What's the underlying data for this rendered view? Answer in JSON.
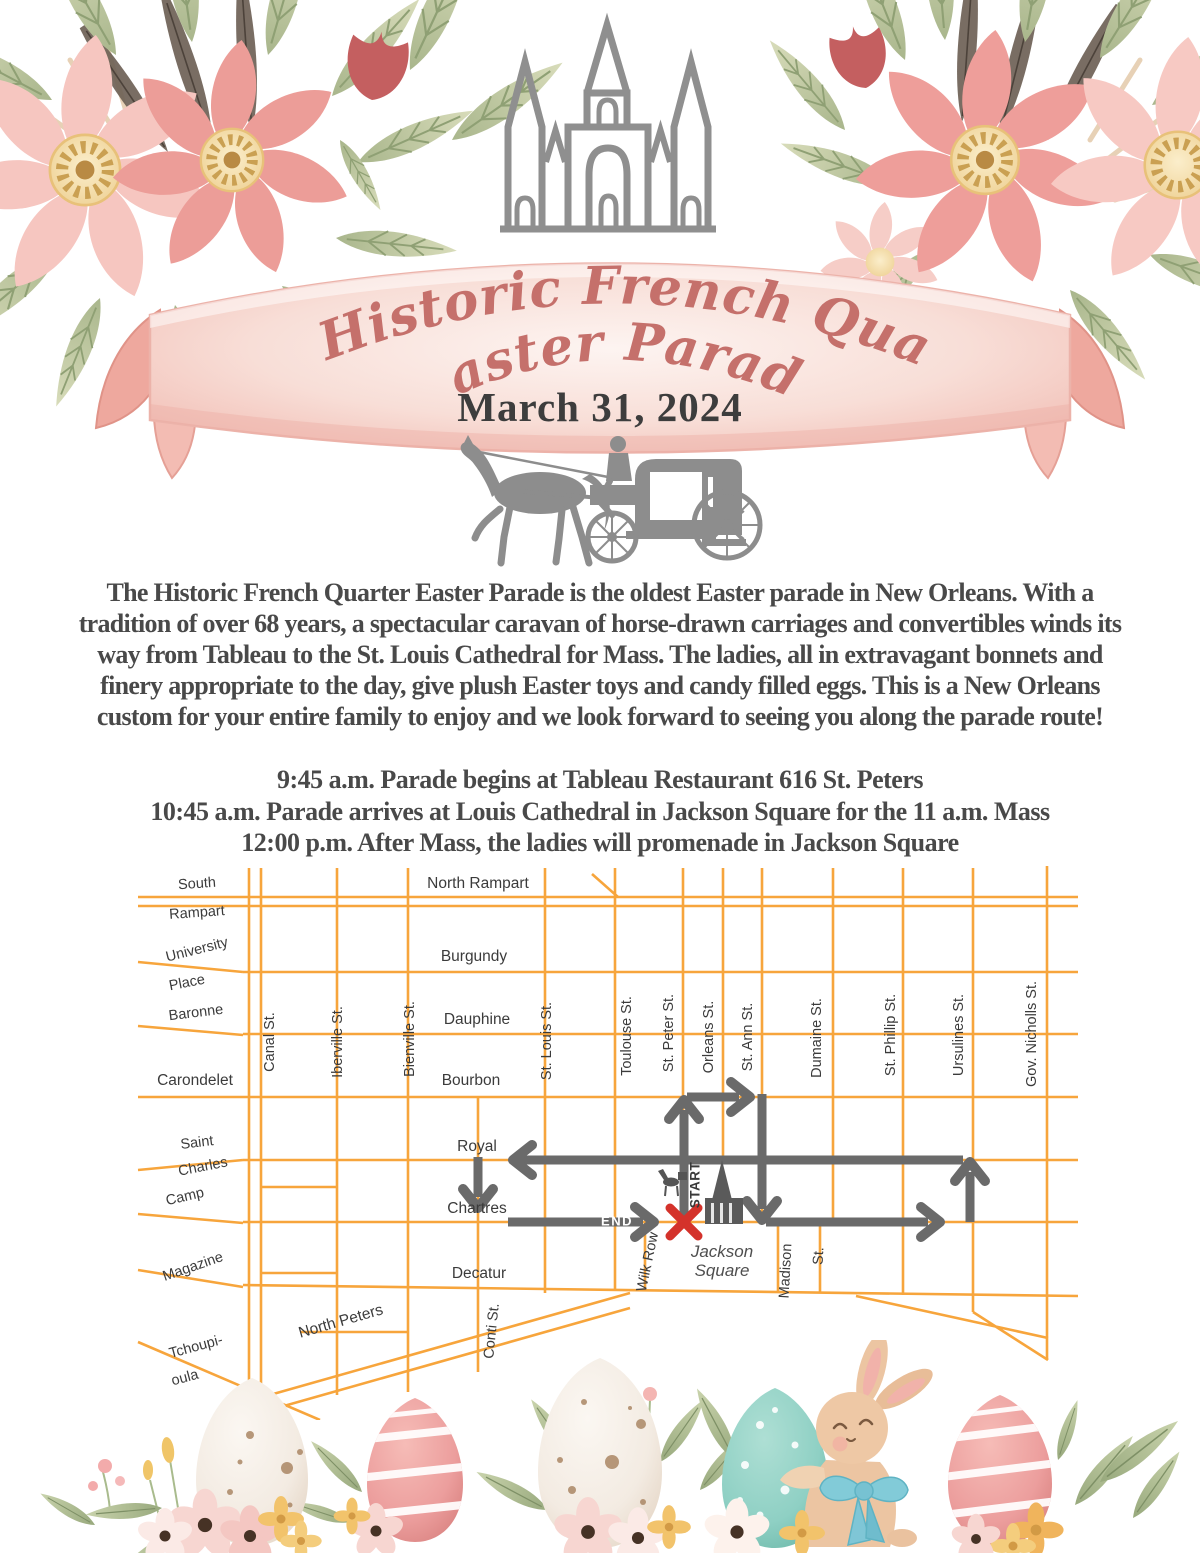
{
  "header": {
    "title_line1": "The Historic French Quarter",
    "title_line2": "Easter Parade",
    "date": "March 31, 2024"
  },
  "intro": {
    "lines": [
      "The Historic French Quarter Easter Parade is the oldest Easter parade in New Orleans. With a",
      "tradition of over 68 years, a spectacular caravan of horse-drawn carriages and convertibles winds its",
      "way from Tableau to the St. Louis Cathedral for Mass. The ladies, all in extravagant bonnets and",
      "finery appropriate to the day, give plush Easter toys and candy filled eggs. This is a New Orleans",
      "custom for your entire family to enjoy and we look forward to seeing you along the parade route!"
    ]
  },
  "schedule": {
    "lines": [
      "9:45 a.m. Parade begins at Tableau Restaurant 616 St. Peters",
      "10:45 a.m. Parade arrives at Louis Cathedral in Jackson Square for the 11 a.m. Mass",
      "12:00 p.m. After Mass, the ladies will promenade in Jackson Square"
    ]
  },
  "map": {
    "colors": {
      "street": "#F7A53C",
      "route": "#6A6A6A",
      "marker_x": "#D4322B",
      "label_text": "#3B3B3B",
      "title_rose": "#C5706B",
      "ribbon_pink": "#F5C9C1"
    },
    "labels": {
      "north_rampart": "North Rampart",
      "burgundy": "Burgundy",
      "dauphine": "Dauphine",
      "bourbon": "Bourbon",
      "royal": "Royal",
      "chartres": "Chartres",
      "decatur": "Decatur",
      "north_peters": "North Peters",
      "south": "South",
      "rampart": "Rampart",
      "university": "University",
      "place": "Place",
      "baronne": "Baronne",
      "carondelet": "Carondelet",
      "saint": "Saint",
      "charles": "Charles",
      "camp": "Camp",
      "magazine": "Magazine",
      "tchoupi": "Tchoupi-",
      "toulas": "oula",
      "canal": "Canal St.",
      "iberville": "Iberville St.",
      "bienville": "Bienville St.",
      "st_louis": "St. Louis St.",
      "toulouse": "Toulouse St.",
      "st_peter": "St. Peter St.",
      "orleans": "Orleans St.",
      "st_ann": "St. Ann St.",
      "dumaine": "Dumaine St.",
      "st_phillip": "St. Phillip St.",
      "ursulines": "Ursulines St.",
      "gov_nicholls": "Gov. Nicholls St.",
      "conti": "Conti St.",
      "wilk_row": "Wilk Row",
      "madison": "Madison",
      "madison_st": "St.",
      "jackson_1": "Jackson",
      "jackson_2": "Square",
      "start": "START",
      "end": "END"
    }
  }
}
